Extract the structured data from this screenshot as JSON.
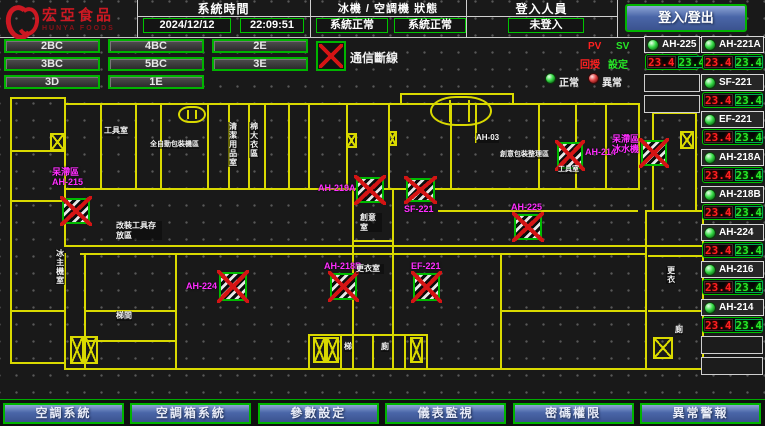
{
  "header": {
    "logo_text": "宏亞食品",
    "logo_sub": "HUNYA FOODS",
    "time_label": "系統時間",
    "date": "2024/12/12",
    "time": "22:09:51",
    "status_label": "冰機 / 空調機 狀態",
    "status_left": "系統正常",
    "status_right": "系統正常",
    "login_label": "登入人員",
    "login_value": "未登入",
    "login_button": "登入/登出"
  },
  "floors": [
    "2BC",
    "4BC",
    "2E",
    "3BC",
    "5BC",
    "3E",
    "3D",
    "1E"
  ],
  "legend": {
    "comm": "通信斷線",
    "pv": "PV",
    "sv": "SV",
    "feedback": "回授",
    "setting": "設定",
    "normal": "正常",
    "abnormal": "異常"
  },
  "colors": {
    "accent_green": "#00c400",
    "alarm_red": "#d41414",
    "wall_yellow": "#d9d900",
    "device_label_magenta": "#ff2dff",
    "nav_blue": "#4a66a8",
    "pv_red": "#ff2020",
    "sv_green": "#27e827"
  },
  "units_left": [
    {
      "name": "AH-225",
      "pv": "23.4",
      "sv": "23.4",
      "y": 36
    }
  ],
  "units_right": [
    {
      "name": "AH-221A",
      "pv": "23.4",
      "sv": "23.4",
      "y": 36
    },
    {
      "name": "SF-221",
      "pv": "23.4",
      "sv": "23.4",
      "y": 74
    },
    {
      "name": "EF-221",
      "pv": "23.4",
      "sv": "23.4",
      "y": 111
    },
    {
      "name": "AH-218A",
      "pv": "23.4",
      "sv": "23.4",
      "y": 149
    },
    {
      "name": "AH-218B",
      "pv": "23.4",
      "sv": "23.4",
      "y": 186
    },
    {
      "name": "AH-224",
      "pv": "23.4",
      "sv": "23.4",
      "y": 224
    },
    {
      "name": "AH-216",
      "pv": "23.4",
      "sv": "23.4",
      "y": 261
    },
    {
      "name": "AH-214",
      "pv": "23.4",
      "sv": "23.4",
      "y": 299
    }
  ],
  "empty_slots_left": [
    {
      "y": 74
    },
    {
      "y": 95
    }
  ],
  "empty_slots_right": [
    {
      "y": 336
    },
    {
      "y": 357
    }
  ],
  "map": {
    "walls": [
      [
        10,
        97,
        54,
        "h"
      ],
      [
        10,
        97,
        265,
        "v"
      ],
      [
        64,
        97,
        148,
        "v"
      ],
      [
        10,
        362,
        54,
        "h"
      ],
      [
        12,
        150,
        52,
        "h"
      ],
      [
        12,
        200,
        52,
        "h"
      ],
      [
        12,
        310,
        52,
        "h"
      ],
      [
        64,
        103,
        574,
        "h"
      ],
      [
        64,
        188,
        574,
        "h"
      ],
      [
        638,
        103,
        87,
        "v"
      ],
      [
        100,
        103,
        85,
        "v"
      ],
      [
        135,
        103,
        85,
        "v"
      ],
      [
        160,
        103,
        85,
        "v"
      ],
      [
        207,
        103,
        85,
        "v"
      ],
      [
        228,
        103,
        85,
        "v"
      ],
      [
        248,
        103,
        85,
        "v"
      ],
      [
        264,
        103,
        85,
        "v"
      ],
      [
        288,
        103,
        85,
        "v"
      ],
      [
        308,
        103,
        85,
        "v"
      ],
      [
        346,
        103,
        85,
        "v"
      ],
      [
        388,
        103,
        85,
        "v"
      ],
      [
        450,
        103,
        85,
        "v"
      ],
      [
        475,
        103,
        40,
        "v"
      ],
      [
        538,
        103,
        85,
        "v"
      ],
      [
        575,
        103,
        85,
        "v"
      ],
      [
        605,
        103,
        85,
        "v"
      ],
      [
        400,
        93,
        112,
        "h"
      ],
      [
        400,
        93,
        10,
        "v"
      ],
      [
        512,
        93,
        10,
        "v"
      ],
      [
        64,
        245,
        638,
        "h"
      ],
      [
        80,
        253,
        565,
        "h"
      ],
      [
        64,
        253,
        115,
        "v"
      ],
      [
        84,
        253,
        115,
        "v"
      ],
      [
        175,
        253,
        115,
        "v"
      ],
      [
        84,
        368,
        93,
        "h"
      ],
      [
        84,
        310,
        91,
        "h"
      ],
      [
        84,
        340,
        91,
        "h"
      ],
      [
        352,
        190,
        178,
        "v"
      ],
      [
        392,
        190,
        178,
        "v"
      ],
      [
        352,
        368,
        42,
        "h"
      ],
      [
        352,
        240,
        40,
        "h"
      ],
      [
        64,
        368,
        244,
        "h"
      ],
      [
        426,
        368,
        222,
        "h"
      ],
      [
        308,
        334,
        118,
        "h"
      ],
      [
        308,
        368,
        118,
        "h"
      ],
      [
        308,
        334,
        34,
        "v"
      ],
      [
        426,
        334,
        34,
        "v"
      ],
      [
        340,
        334,
        34,
        "v"
      ],
      [
        372,
        334,
        34,
        "v"
      ],
      [
        404,
        334,
        34,
        "v"
      ],
      [
        645,
        210,
        158,
        "v"
      ],
      [
        702,
        210,
        158,
        "v"
      ],
      [
        645,
        210,
        57,
        "h"
      ],
      [
        645,
        368,
        59,
        "h"
      ],
      [
        648,
        255,
        54,
        "h"
      ],
      [
        648,
        310,
        54,
        "h"
      ],
      [
        438,
        210,
        200,
        "h"
      ],
      [
        500,
        253,
        115,
        "v"
      ],
      [
        500,
        310,
        145,
        "h"
      ],
      [
        652,
        112,
        98,
        "v"
      ],
      [
        695,
        112,
        98,
        "v"
      ],
      [
        652,
        112,
        43,
        "h"
      ]
    ],
    "rounds": [
      [
        178,
        106,
        28,
        17
      ],
      [
        430,
        96,
        62,
        30
      ]
    ],
    "stairs": [
      [
        50,
        133,
        15,
        18
      ],
      [
        346,
        133,
        11,
        15
      ],
      [
        388,
        131,
        9,
        15
      ],
      [
        70,
        336,
        14,
        28
      ],
      [
        84,
        336,
        14,
        28
      ],
      [
        313,
        337,
        13,
        26
      ],
      [
        326,
        337,
        13,
        26
      ],
      [
        410,
        337,
        13,
        26
      ],
      [
        653,
        337,
        20,
        22
      ],
      [
        680,
        131,
        14,
        18
      ]
    ],
    "devices": [
      {
        "lines": [
          "呆滯區",
          "AH-215"
        ],
        "x": 62,
        "y": 198,
        "w": 28,
        "h": 26,
        "lx": 52,
        "ly": 168
      },
      {
        "lines": [
          "AH-219A"
        ],
        "x": 356,
        "y": 177,
        "w": 28,
        "h": 26,
        "lx": 318,
        "ly": 184
      },
      {
        "lines": [
          "SF-221"
        ],
        "x": 406,
        "y": 178,
        "w": 29,
        "h": 24,
        "lx": 404,
        "ly": 205
      },
      {
        "lines": [
          "AH-225"
        ],
        "x": 514,
        "y": 214,
        "w": 28,
        "h": 26,
        "lx": 511,
        "ly": 203
      },
      {
        "lines": [
          "AH-218B"
        ],
        "x": 330,
        "y": 273,
        "w": 27,
        "h": 27,
        "lx": 324,
        "ly": 262
      },
      {
        "lines": [
          "EF-221"
        ],
        "x": 413,
        "y": 273,
        "w": 27,
        "h": 28,
        "lx": 411,
        "ly": 262
      },
      {
        "lines": [
          "AH-224"
        ],
        "x": 219,
        "y": 272,
        "w": 28,
        "h": 29,
        "lx": 186,
        "ly": 282
      },
      {
        "lines": [
          "AH-214"
        ],
        "x": 557,
        "y": 142,
        "w": 26,
        "h": 27,
        "lx": 585,
        "ly": 148
      },
      {
        "lines": [
          "呆滯區",
          "冰水機"
        ],
        "x": 641,
        "y": 140,
        "w": 26,
        "h": 26,
        "lx": 612,
        "ly": 135
      }
    ],
    "labels": [
      {
        "t": "工具室",
        "x": 104,
        "y": 126,
        "w": 24
      },
      {
        "t": "全自動包裝機區",
        "x": 150,
        "y": 141,
        "fs": 7
      },
      {
        "t": "清潔用品室",
        "x": 228,
        "y": 122,
        "vert": 1
      },
      {
        "t": "棉大衣區",
        "x": 249,
        "y": 122,
        "vert": 1
      },
      {
        "t": "改裝工具存放區",
        "x": 116,
        "y": 221,
        "w": 46
      },
      {
        "t": "AH-03",
        "x": 476,
        "y": 133
      },
      {
        "t": "創意包裝整理區",
        "x": 500,
        "y": 151,
        "fs": 7
      },
      {
        "t": "工具室",
        "x": 558,
        "y": 166,
        "fs": 7
      },
      {
        "t": "創意室",
        "x": 360,
        "y": 213,
        "w": 22
      },
      {
        "t": "更衣室",
        "x": 356,
        "y": 264,
        "w": 28
      },
      {
        "t": "冰主機室",
        "x": 55,
        "y": 249,
        "vert": 1
      },
      {
        "t": "梯間",
        "x": 116,
        "y": 311
      },
      {
        "t": "梯",
        "x": 344,
        "y": 342
      },
      {
        "t": "廁",
        "x": 381,
        "y": 342
      },
      {
        "t": "更衣",
        "x": 666,
        "y": 266,
        "vert": 1
      },
      {
        "t": "廁",
        "x": 675,
        "y": 325
      }
    ]
  },
  "bottom_buttons": [
    "空調系統",
    "空調箱系統",
    "參數設定",
    "儀表監視",
    "密碼權限",
    "異常警報"
  ]
}
